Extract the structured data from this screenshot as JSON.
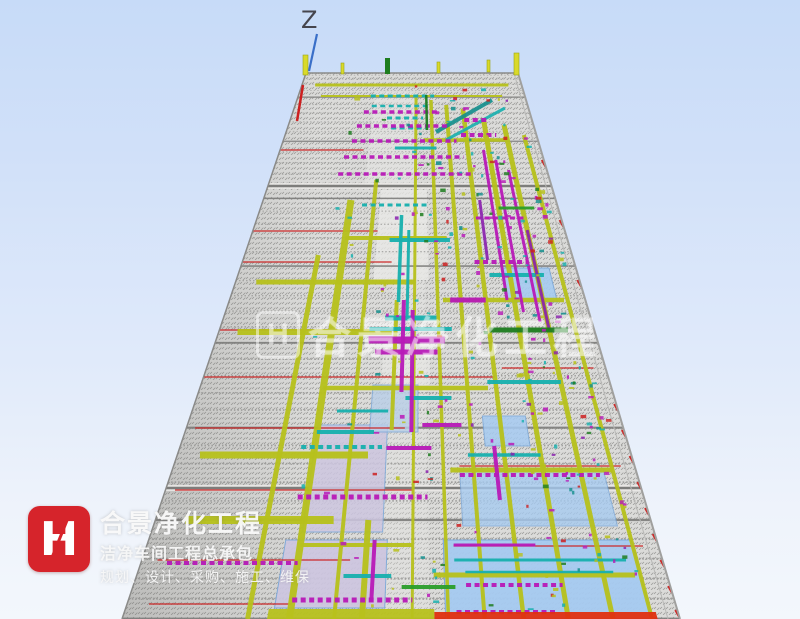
{
  "scene": {
    "axis_label": "Z",
    "background_top": "#c7dbf8",
    "background_bottom": "#f3f7fc",
    "watermark": {
      "mark": "H",
      "text": "合景净化工程",
      "color": "#ffffff"
    }
  },
  "logo": {
    "mark": "H",
    "mark_bg": "#d6242b",
    "title": "合景净化工程",
    "subtitle": "洁净车间工程总承包",
    "tagline": "规划、设计、采购、施工、维保"
  },
  "model": {
    "colors": {
      "base": "#dbdbd9",
      "dot": "#9b9b99",
      "row": "#9a9a98",
      "row_major": "#7d7d7b",
      "edge": "#8a8a88",
      "edge_light": "#b8b8b6",
      "red": "#cc2020",
      "orange_red": "#e03010",
      "olive": "#b7c11c",
      "olive_dark": "#9aa414",
      "magenta": "#b81ab8",
      "purple": "#8a1fae",
      "cyan": "#17b0ae",
      "teal": "#128e8c",
      "green": "#2b9e2b",
      "dark_green": "#1d7d1f",
      "blue_panel": "#a6cbf1",
      "blue_panel_edge": "#7aa7d9",
      "glass": "#b9cfe8",
      "lavender": "#cdc6e0",
      "light_core": "#e8e8e6",
      "yellow_post": "#d9d92a",
      "axis_blue": "#3a6fc8",
      "axis_label_gray": "#45454d"
    },
    "geometry": {
      "top_y": 73,
      "bottom_y": 619,
      "top_left": 306,
      "top_right": 518,
      "bottom_left": 122,
      "bottom_right": 680
    }
  }
}
